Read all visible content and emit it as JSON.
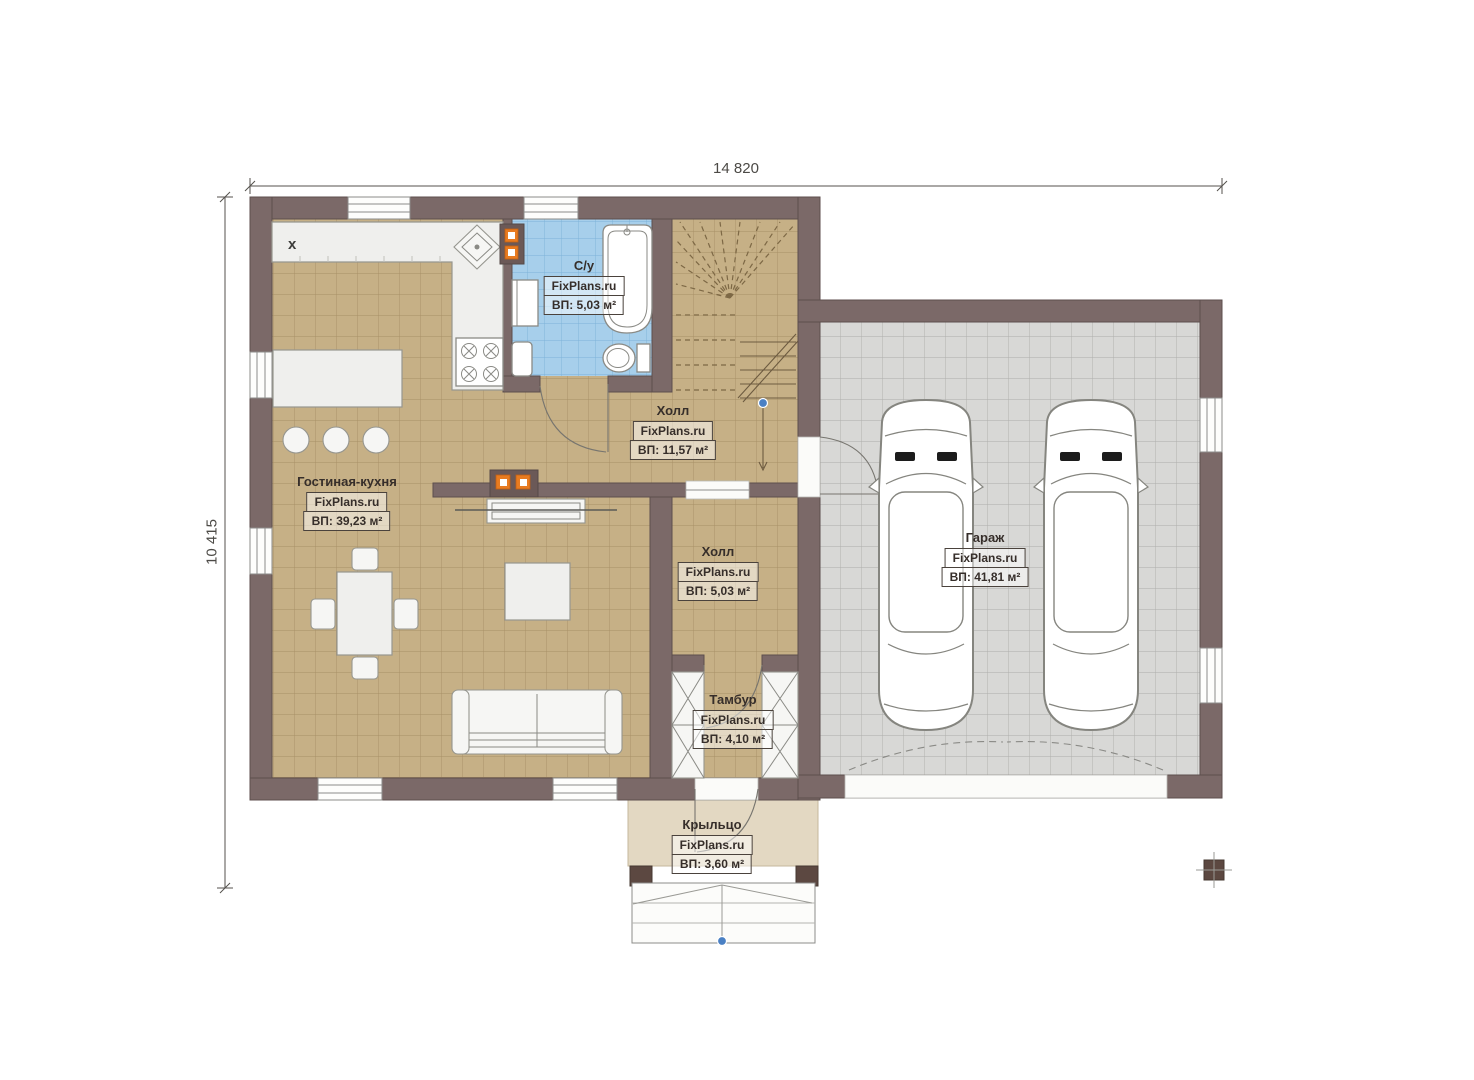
{
  "dimensions": {
    "top": "14 820",
    "left": "10 415"
  },
  "rooms": [
    {
      "key": "living-kitchen",
      "name": "Гостиная-кухня",
      "watermark": "FixPlans.ru",
      "area": "ВП: 39,23 м²"
    },
    {
      "key": "bathroom",
      "name": "С/у",
      "watermark": "FixPlans.ru",
      "area": "ВП: 5,03 м²"
    },
    {
      "key": "hall-upper",
      "name": "Холл",
      "watermark": "FixPlans.ru",
      "area": "ВП: 11,57 м²"
    },
    {
      "key": "hall-lower",
      "name": "Холл",
      "watermark": "FixPlans.ru",
      "area": "ВП: 5,03 м²"
    },
    {
      "key": "tambour",
      "name": "Тамбур",
      "watermark": "FixPlans.ru",
      "area": "ВП: 4,10 м²"
    },
    {
      "key": "porch",
      "name": "Крыльцо",
      "watermark": "FixPlans.ru",
      "area": "ВП: 3,60 м²"
    },
    {
      "key": "garage",
      "name": "Гараж",
      "watermark": "FixPlans.ru",
      "area": "ВП: 41,81 м²"
    }
  ],
  "symbols": {
    "kitchen_mark": "x"
  },
  "colors": {
    "wall": "#7b6968",
    "floor_tan": "#c6b086",
    "floor_blue": "#a7cfeb",
    "floor_gray": "#d8d8d6",
    "orange_accent": "#e87b20",
    "marker_blue": "#4a80c4",
    "porch": "#e3d8c2"
  }
}
